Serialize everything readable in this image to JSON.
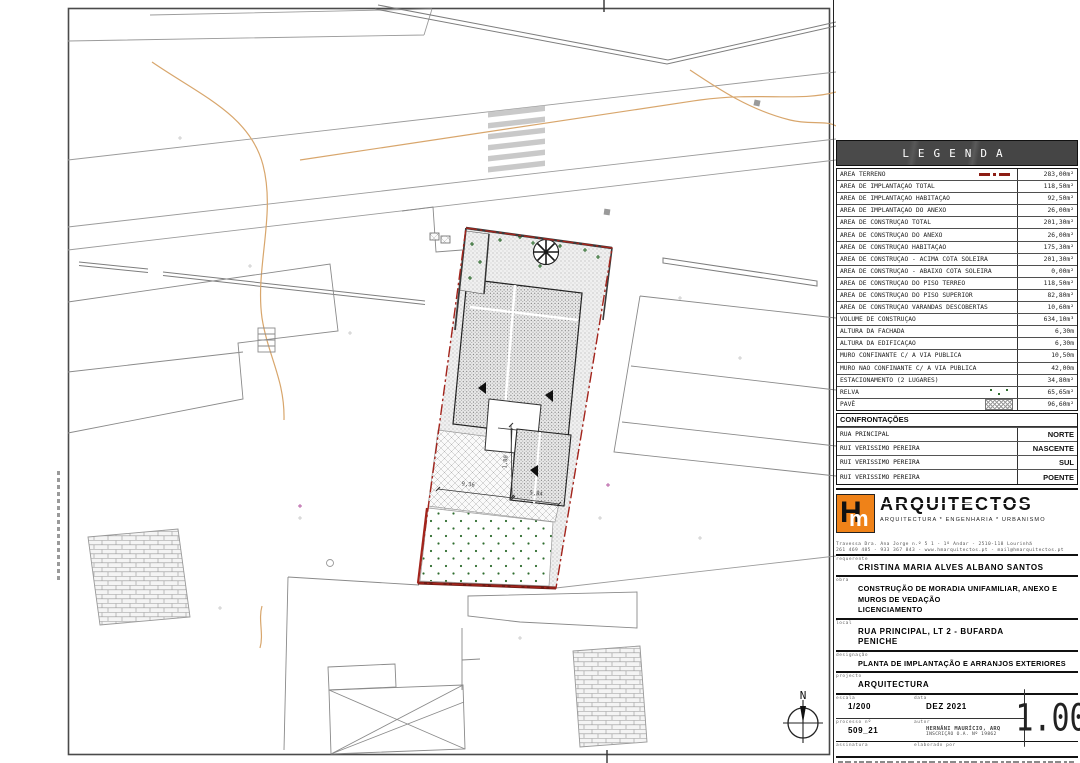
{
  "legend": {
    "title": "LEGENDA",
    "rows": [
      {
        "label": "ÁREA TERRENO",
        "value": "283,00m²",
        "symbol": "terreno-dashdot-line"
      },
      {
        "label": "ÁREA DE IMPLANTAÇÃO TOTAL",
        "value": "118,50m²"
      },
      {
        "label": "ÁREA DE IMPLANTAÇÃO HABITAÇÃO",
        "value": "92,50m²"
      },
      {
        "label": "ÁREA DE IMPLANTAÇÃO DO ANEXO",
        "value": "26,00m²"
      },
      {
        "label": "ÁREA DE CONSTRUÇÃO TOTAL",
        "value": "201,30m²"
      },
      {
        "label": "ÁREA DE CONSTRUÇÃO DO ANEXO",
        "value": "26,00m²"
      },
      {
        "label": "ÁREA DE CONSTRUÇÃO HABITAÇÃO",
        "value": "175,30m²"
      },
      {
        "label": "ÁREA DE CONSTRUÇÃO - ACIMA COTA SOLEIRA",
        "value": "201,30m²"
      },
      {
        "label": "ÁREA DE CONSTRUÇÃO - ABAIXO COTA SOLEIRA",
        "value": "0,00m²"
      },
      {
        "label": "ÁREA DE CONSTRUÇÃO DO PISO TÉRREO",
        "value": "118,50m²"
      },
      {
        "label": "ÁREA DE CONSTRUÇÃO DO PISO SUPERIOR",
        "value": "82,80m²"
      },
      {
        "label": "ÁREA DE CONSTRUÇÃO VARANDAS DESCOBERTAS",
        "value": "10,60m²"
      },
      {
        "label": "VOLUME DE CONSTRUÇÃO",
        "value": "634,10m³"
      },
      {
        "label": "ALTURA DA FACHADA",
        "value": "6,30m"
      },
      {
        "label": "ALTURA DA EDIFICAÇÃO",
        "value": "6,30m"
      },
      {
        "label": "MURO CONFINANTE C/ A VIA PÚBLICA",
        "value": "10,50m"
      },
      {
        "label": "MURO NÃO CONFINANTE C/ A VIA PÚBLICA",
        "value": "42,00m"
      },
      {
        "label": "ESTACIONAMENTO (2 LUGARES)",
        "value": "34,80m²"
      },
      {
        "label": "RELVA",
        "value": "65,65m²",
        "symbol": "relva-dots"
      },
      {
        "label": "PAVÊ",
        "value": "96,60m²",
        "symbol": "pave-hatch"
      }
    ]
  },
  "confrontacoes": {
    "title": "CONFRONTAÇÕES",
    "rows": [
      {
        "name": "RUA PRINCIPAL",
        "side": "NORTE"
      },
      {
        "name": "RUI VERISSIMO PEREIRA",
        "side": "NASCENTE"
      },
      {
        "name": "RUI VERISSIMO PEREIRA",
        "side": "SUL"
      },
      {
        "name": "RUI VERISSIMO PEREIRA",
        "side": "POENTE"
      }
    ]
  },
  "firm": {
    "logo_h": "H",
    "logo_m": "m",
    "name": "ARQUITECTOS",
    "tagline": "ARQUITECTURA * ENGENHARIA * URBANISMO",
    "address": "Travessa Dra. Ana Jorge n.º 5 1 - 1º Andar - 2510-118 Lourinhã",
    "contacts": "261 469 485 - 933 367 843 - www.hmarquitectos.pt - mail@hmarquitectos.pt",
    "logo_color": "#ef8218"
  },
  "fields": {
    "requerente_label": "requerente",
    "requerente": "CRISTINA MARIA ALVES ALBANO SANTOS",
    "obra_label": "obra",
    "obra_line1": "CONSTRUÇÃO DE MORADIA UNIFAMILIAR, ANEXO E",
    "obra_line2": "MUROS DE VEDAÇÃO",
    "obra_line3": "LICENCIAMENTO",
    "local_label": "local",
    "local_line1": "RUA PRINCIPAL, LT 2 - BUFARDA",
    "local_line2": "PENICHE",
    "designacao_label": "designação",
    "designacao": "PLANTA DE IMPLANTAÇÃO E ARRANJOS EXTERIORES",
    "projecto_label": "projecto",
    "projecto": "ARQUITECTURA",
    "escala_label": "escala",
    "escala": "1/200",
    "data_label": "data",
    "data": "DEZ 2021",
    "desenho_label": "desenho nº",
    "desenho": "1.00",
    "processo_label": "processo nº",
    "processo": "509_21",
    "autor_label": "autor",
    "autor": "HERNÂNI MAURÍCIO, ARQ",
    "autor_sub": "INSCRIÇÃO O.A. Nº 19862",
    "assinatura_label": "assinatura",
    "elaborado_label": "elaborado por"
  },
  "plan": {
    "north_label": "N",
    "dims": {
      "d1": "9,36",
      "d2": "5,84",
      "d3": "1,80"
    },
    "colors": {
      "boundary_red": "#a3241c",
      "contour_orange": "#d8a66c",
      "grass_green": "#2e6d2e",
      "line_gray": "#9b9b9b"
    }
  }
}
